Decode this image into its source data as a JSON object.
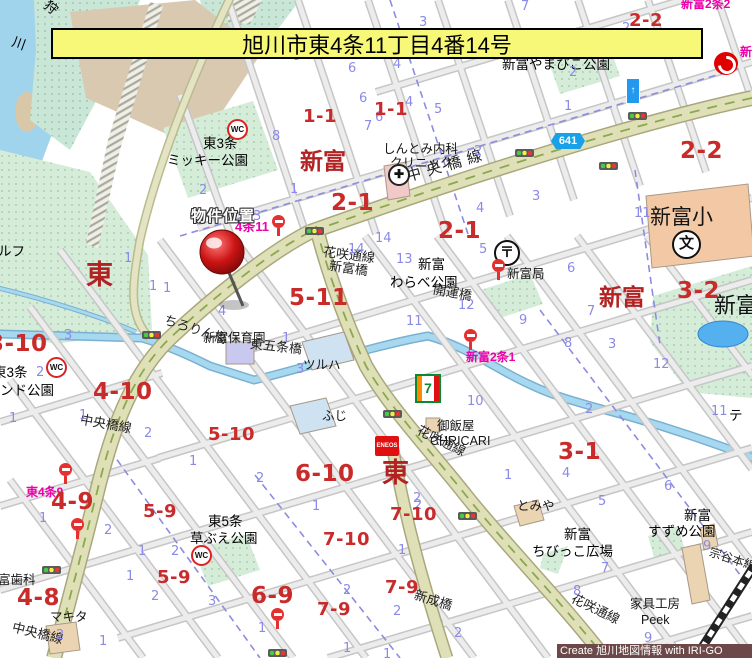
{
  "title": "旭川市東4条11丁目4番14号",
  "credit": "Create 旭川地図情報 with IRI-GO",
  "marker": {
    "label": "物件位置"
  },
  "route_badge": "641",
  "icons": {
    "wc": "WC",
    "post": "〒",
    "school": "文",
    "hospital": "✚",
    "oneway": "↑",
    "seven": "7",
    "eneos": "ENEOS"
  },
  "bus_stop_labels": [
    "新富2条2",
    "4条11",
    "新富2条1",
    "東4条9",
    "新富"
  ],
  "districts": [
    "新富",
    "新富",
    "東",
    "東"
  ],
  "blocks": [
    "1-1",
    "1-1",
    "2-1",
    "2-1",
    "2-2",
    "2-2",
    "3-2",
    "5-11",
    "3-10",
    "4-10",
    "5-10",
    "4-9",
    "5-9",
    "5-9",
    "4-8",
    "6-10",
    "7-10",
    "7-10",
    "3-1",
    "6-9",
    "7-9",
    "7-9"
  ],
  "lots": [
    "9",
    "6",
    "6",
    "8",
    "7",
    "7",
    "3",
    "2",
    "4",
    "2",
    "4",
    "5",
    "1",
    "6",
    "2",
    "3",
    "4",
    "5",
    "14",
    "14",
    "13",
    "2",
    "2",
    "3",
    "1",
    "1",
    "1",
    "4",
    "11",
    "6",
    "7",
    "8",
    "3",
    "12",
    "2",
    "11",
    "4",
    "5",
    "6",
    "1",
    "9",
    "7",
    "8",
    "9",
    "1",
    "3",
    "10",
    "2",
    "2",
    "1",
    "12",
    "11",
    "9",
    "1",
    "3",
    "2",
    "1",
    "1",
    "2",
    "1",
    "1",
    "2",
    "1",
    "2",
    "1",
    "2",
    "2",
    "1",
    "1",
    "2",
    "2",
    "3",
    "1",
    "1",
    "2",
    "1",
    "2"
  ],
  "places": {
    "yamabiko": "新富やまびこ公園",
    "clinic1": "しんとみ内科",
    "clinic2": "クリニック",
    "mickey1": "東3条",
    "mickey2": "ミッキー公園",
    "warabe1": "新富",
    "warabe2": "わらべ公園",
    "post_label": "新富局",
    "shinfu_sho": "新富小",
    "shinfu_park": "新富",
    "hoikuen": "新富保育園",
    "tsuruha": "ツルハ",
    "fuji": "ふじ",
    "gohan1": "御飯屋",
    "gohan2": "CHRICARI",
    "tomiya": "とみや",
    "suzume1": "新富",
    "suzume2": "すずめ公園",
    "chibi1": "新富",
    "chibi2": "ちびっこ広場",
    "kusabue1": "東5条",
    "kusabue2": "草ぶえ公園",
    "makita": "マキタ",
    "shika": "富歯科",
    "kagu1": "家具工房",
    "kagu2": "Peek",
    "golf": "ルフ",
    "higashi3_1": "東3条",
    "higashi3_2": "ンド公園",
    "te": "テ"
  },
  "roads": {
    "chuo": "中央橋線",
    "chuo_v1": "中央橋線",
    "chuo_v2": "中央橋線",
    "hanasaki1": "花咲通線",
    "hanasaki2": "花咲通線",
    "hanasaki3": "花咲通線",
    "soya": "宗谷本線"
  },
  "bridges": [
    "ちろりん橋",
    "東五条橋",
    "新富橋",
    "開運橋",
    "新成橋"
  ],
  "water": {
    "river_char1": "狩",
    "river_char2": "川"
  }
}
